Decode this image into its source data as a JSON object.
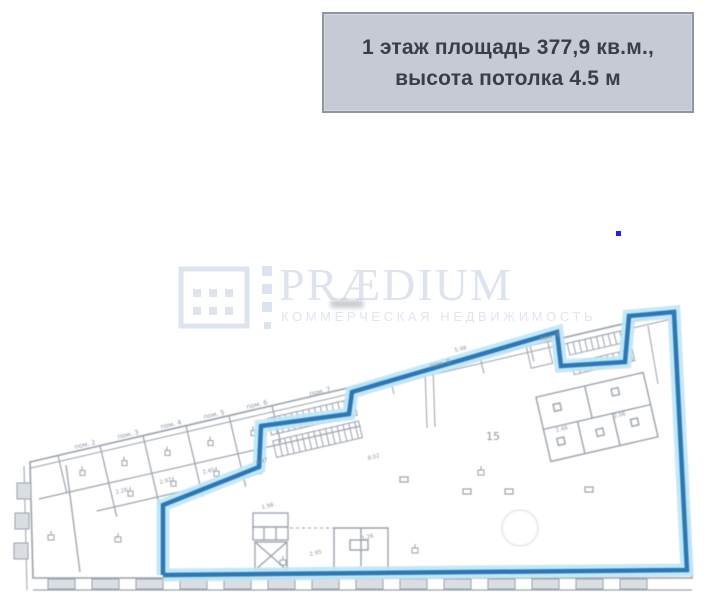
{
  "header": {
    "line1": "1 этаж площадь 377,9 кв.м.,",
    "line2": "высота потолка 4.5 м",
    "bg_color": "#c5cad5",
    "border_color": "#8f96a2",
    "text_color": "#3a3e47"
  },
  "watermark": {
    "brand": "PRÆDIUM",
    "tagline": "КОММЕРЧЕСКАЯ НЕДВИЖИМОСТЬ",
    "color": "#dde4ef"
  },
  "plan": {
    "hall_number": "15",
    "colors": {
      "outline_blue": "#2c78b4",
      "outline_glow": "#bfe6f7",
      "wall_gray": "#9aa2ac",
      "window_fill": "#dadee3"
    },
    "blue_outline_points": "163,575 163,505 259,467 261,426 349,414 352,392 557,332 561,366 625,362 629,316 674,312 687,570 163,575",
    "room_labels": [
      {
        "x": 75,
        "y": 449,
        "text": "пом. 2"
      },
      {
        "x": 118,
        "y": 439,
        "text": "пом. 3"
      },
      {
        "x": 161,
        "y": 429,
        "text": "пом. 4"
      },
      {
        "x": 204,
        "y": 419,
        "text": "пом. 5"
      },
      {
        "x": 247,
        "y": 409,
        "text": "пом. 6"
      },
      {
        "x": 310,
        "y": 396,
        "text": "пом. 7"
      },
      {
        "x": 430,
        "y": 368,
        "text": "пом. 8"
      },
      {
        "x": 540,
        "y": 341,
        "text": "пом. 9"
      }
    ],
    "dim_labels": [
      {
        "x": 116,
        "y": 494,
        "text": "2.28"
      },
      {
        "x": 160,
        "y": 484,
        "text": "2.92"
      },
      {
        "x": 203,
        "y": 474,
        "text": "2.45"
      },
      {
        "x": 256,
        "y": 464,
        "text": "4.97"
      },
      {
        "x": 368,
        "y": 460,
        "text": "8.02"
      },
      {
        "x": 455,
        "y": 352,
        "text": "5.98"
      },
      {
        "x": 262,
        "y": 509,
        "text": "1.98"
      },
      {
        "x": 310,
        "y": 556,
        "text": "2.95"
      },
      {
        "x": 362,
        "y": 540,
        "text": "1.26"
      },
      {
        "x": 556,
        "y": 432,
        "text": "2.48"
      },
      {
        "x": 614,
        "y": 418,
        "text": "2.06"
      }
    ]
  },
  "misc": {
    "blue_dot_color": "#2222e0"
  }
}
